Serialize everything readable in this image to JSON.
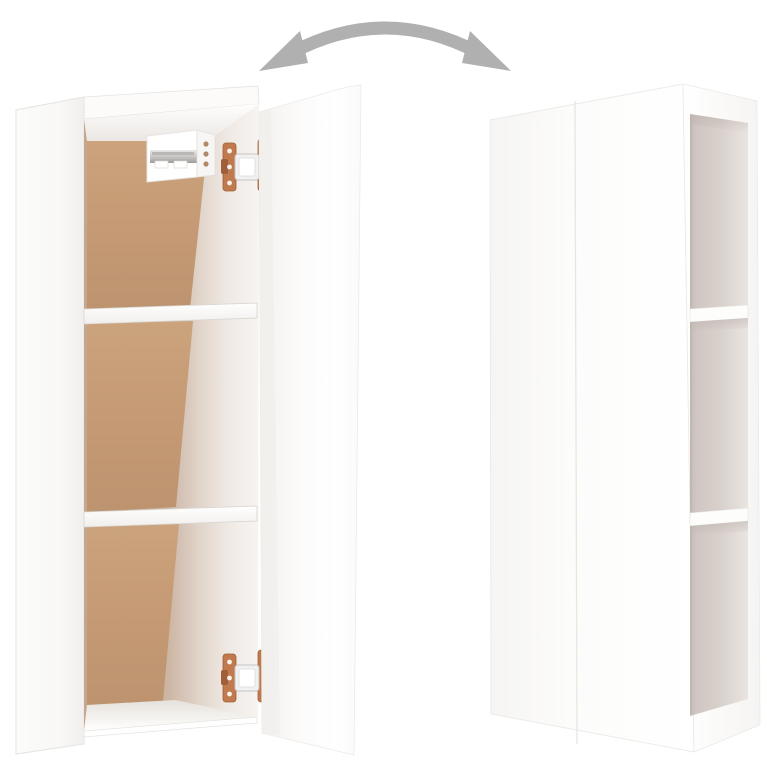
{
  "image": {
    "subject": "Two white wall-mounted cabinets: left unit shown open with door swung out, right unit shown closed from the side",
    "background_color": "#ffffff"
  },
  "icons": [
    {
      "name": "rotation-arrow-icon",
      "meaning": "door swings between open and closed position",
      "color": "#b1b0b0"
    },
    {
      "name": "top-hinge-icon",
      "color": "#c07a4d"
    },
    {
      "name": "bottom-hinge-icon",
      "color": "#c07a4d"
    },
    {
      "name": "wall-mount-bracket",
      "color": "#f1f1f1"
    }
  ],
  "left_cabinet": {
    "state": "open",
    "compartments": 3,
    "shelves": 2,
    "back_panel_material": "wood",
    "hinge_count": 2
  },
  "right_cabinet": {
    "state": "closed",
    "visible_side": "right",
    "side_compartments": 3,
    "front_seam": true
  },
  "colors": {
    "bg": "#ffffff",
    "edge_line": "#e6e3e0",
    "edge_strong": "#d9d6d2",
    "wood_light": "#cba37c",
    "wood_mid": "#c59a74",
    "wood_dark": "#bd9470",
    "arrow_gray": "#b1b0b0",
    "copper": "#c07a4d",
    "copper_dark": "#a05f38",
    "silver_light": "#f1f1f1",
    "hole_dark": "#b08a68",
    "side_int_dark": "#c6bcb6",
    "side_int_mid": "#d9d1cc",
    "side_int_light": "#eae5e2"
  }
}
